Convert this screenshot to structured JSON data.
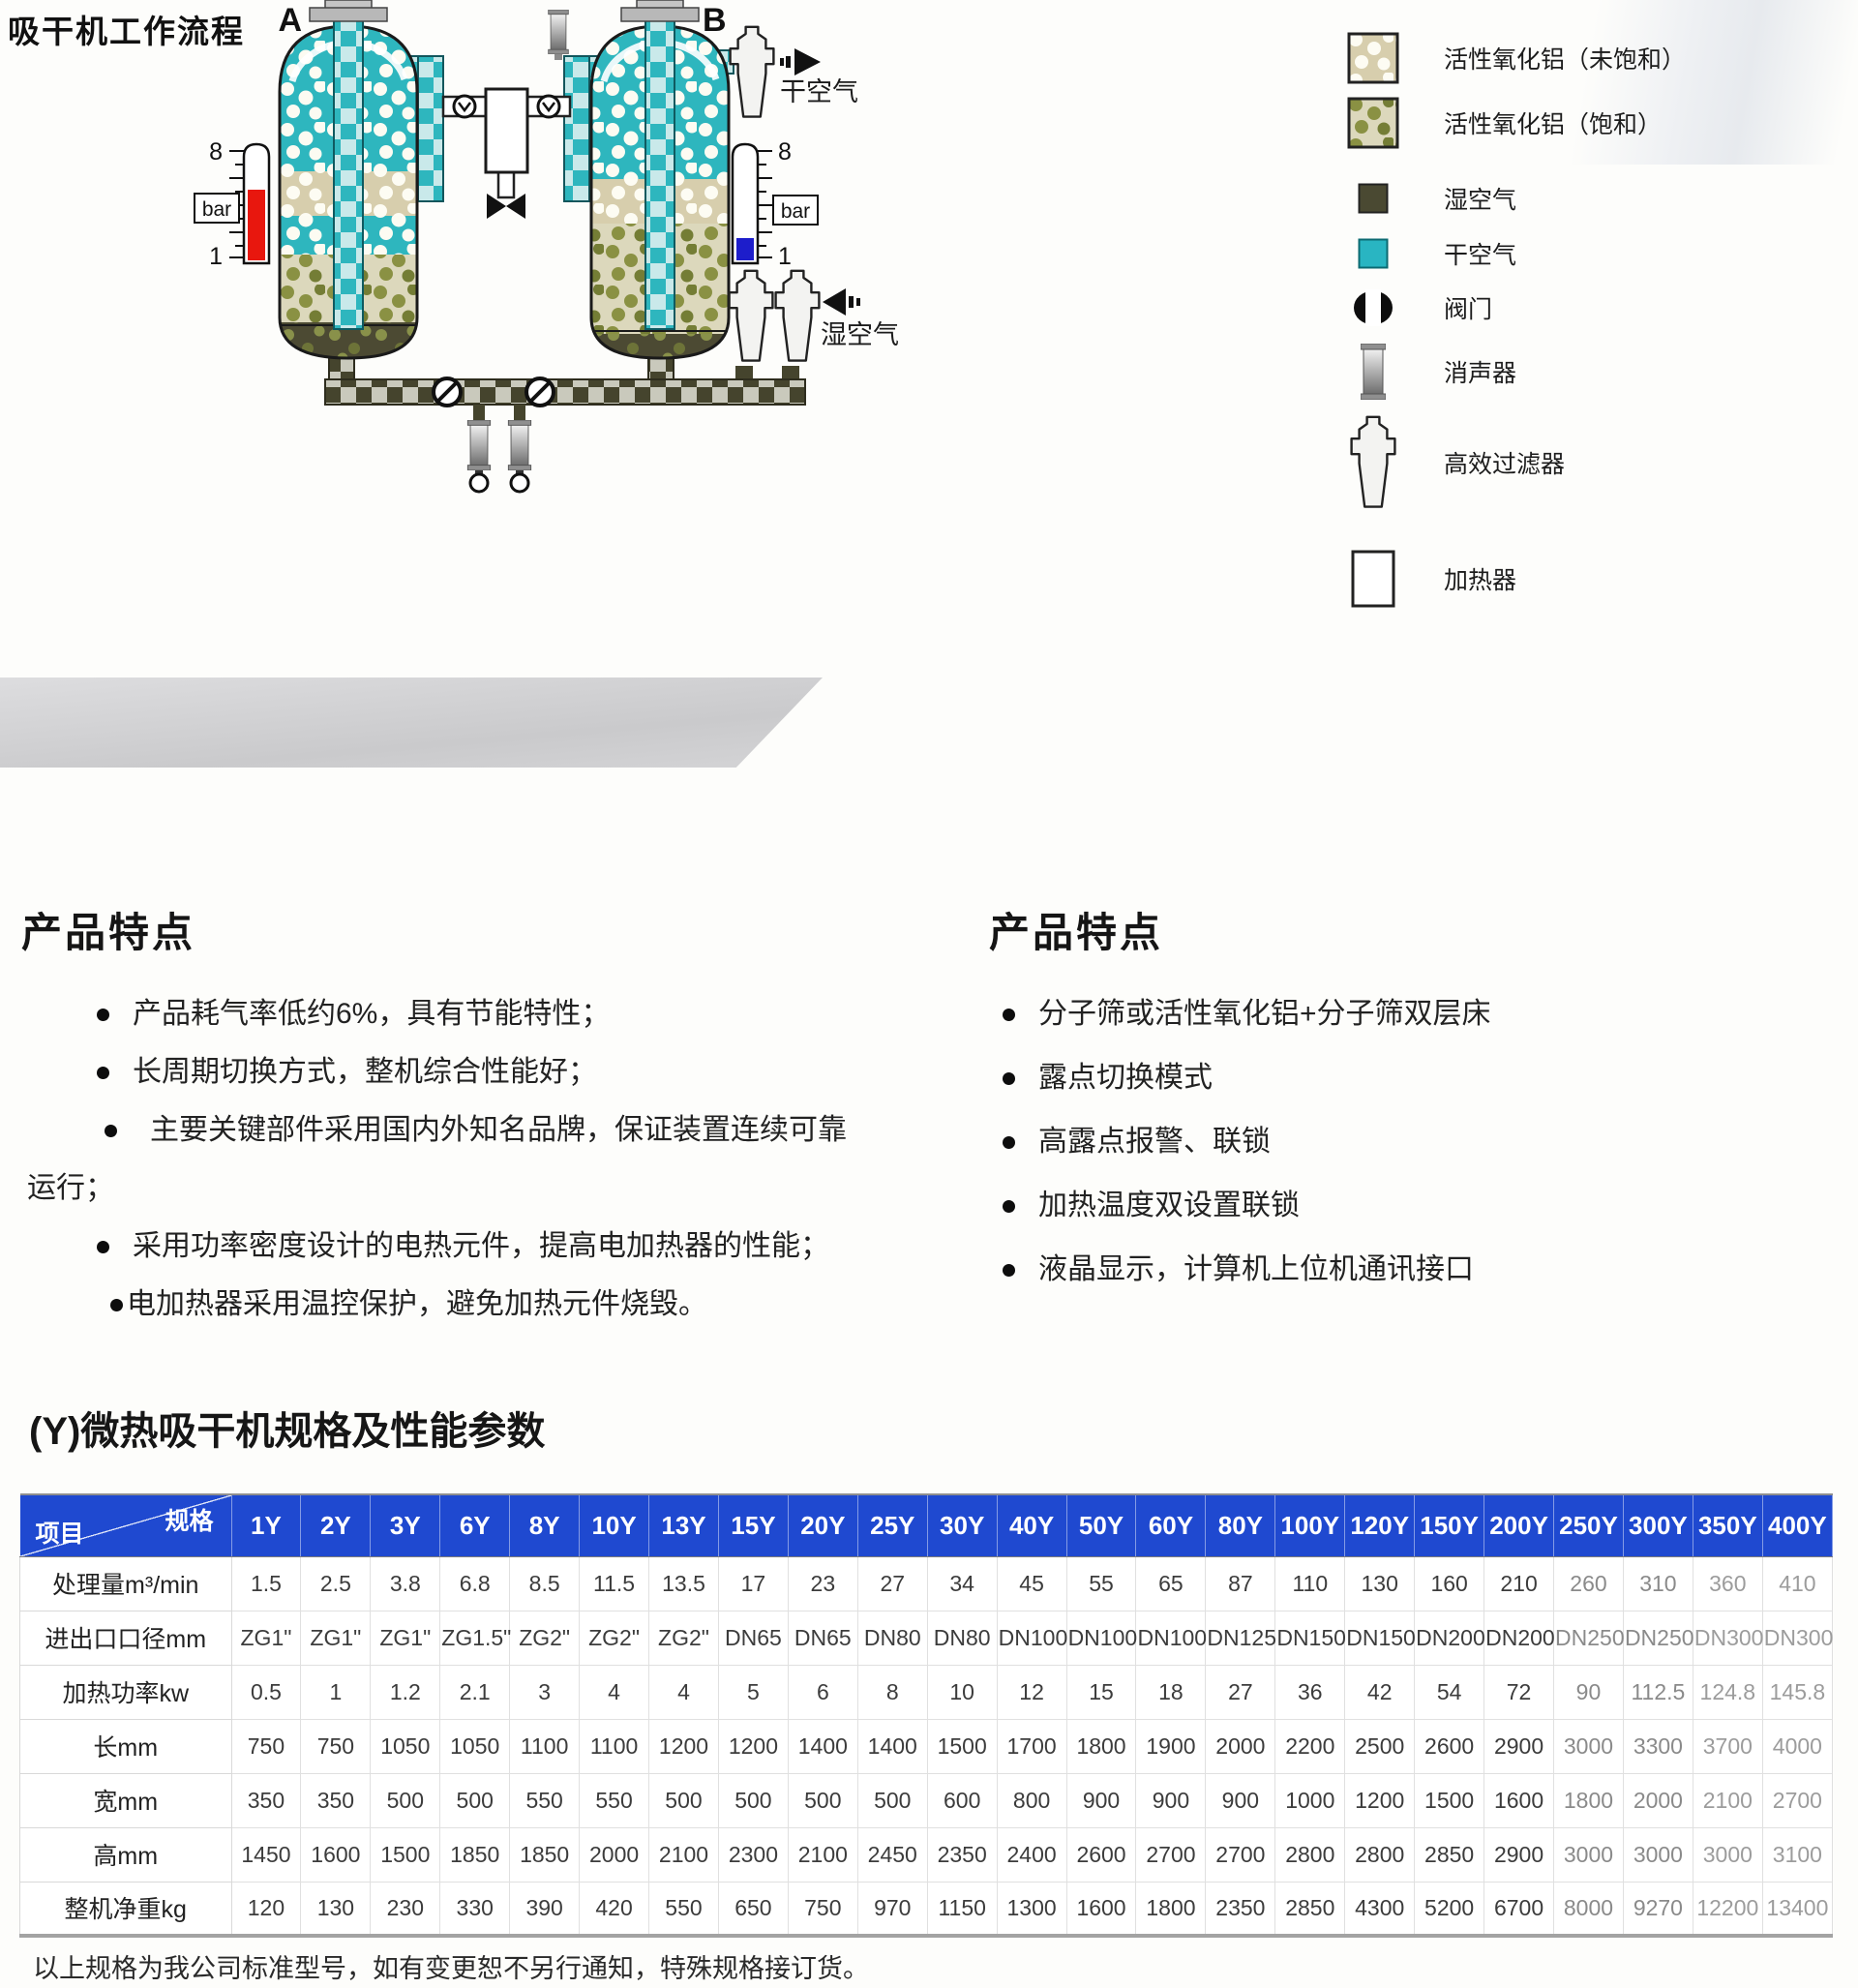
{
  "page": {
    "title": "吸干机工作流程",
    "note": "以上规格为我公司标准型号，如有变更恕不另行通知，特殊规格接订货。"
  },
  "diagram": {
    "vessel_a": "A",
    "vessel_b": "B",
    "dry_air": "干空气",
    "wet_air": "湿空气",
    "bar": "bar",
    "gauge_max": "8",
    "gauge_min": "1",
    "legend": [
      {
        "icon": "alumina-unsaturated-swatch",
        "label": "活性氧化铝（未饱和）"
      },
      {
        "icon": "alumina-saturated-swatch",
        "label": "活性氧化铝（饱和）"
      },
      {
        "icon": "wet-air-swatch",
        "label": "湿空气"
      },
      {
        "icon": "dry-air-swatch",
        "label": "干空气"
      },
      {
        "icon": "valve-icon",
        "label": "阀门"
      },
      {
        "icon": "muffler-icon",
        "label": "消声器"
      },
      {
        "icon": "filter-icon",
        "label": "高效过滤器"
      },
      {
        "icon": "heater-icon",
        "label": "加热器"
      }
    ]
  },
  "features_left": {
    "heading": "产品特点",
    "items": [
      {
        "bullet": true,
        "text": "产品耗气率低约6%，具有节能特性；"
      },
      {
        "bullet": true,
        "text": "长周期切换方式，整机综合性能好；"
      },
      {
        "bullet": true,
        "text": "主要关键部件采用国内外知名品牌，保证装置连续可靠"
      },
      {
        "bullet": false,
        "text": "运行；"
      },
      {
        "bullet": true,
        "text": "采用功率密度设计的电热元件，提高电加热器的性能；"
      },
      {
        "bullet": true,
        "text": "电加热器采用温控保护，避免加热元件烧毁。"
      }
    ]
  },
  "features_right": {
    "heading": "产品特点",
    "items": [
      {
        "bullet": true,
        "text": "分子筛或活性氧化铝+分子筛双层床"
      },
      {
        "bullet": true,
        "text": "露点切换模式"
      },
      {
        "bullet": true,
        "text": "高露点报警、联锁"
      },
      {
        "bullet": true,
        "text": "加热温度双设置联锁"
      },
      {
        "bullet": true,
        "text": "液晶显示，计算机上位机通讯接口"
      }
    ]
  },
  "spec_table": {
    "title": "(Y)微热吸干机规格及性能参数",
    "corner": {
      "top_right": "规格",
      "bottom_left": "项目"
    },
    "models": [
      "1Y",
      "2Y",
      "3Y",
      "6Y",
      "8Y",
      "10Y",
      "13Y",
      "15Y",
      "20Y",
      "25Y",
      "30Y",
      "40Y",
      "50Y",
      "60Y",
      "80Y",
      "100Y",
      "120Y",
      "150Y",
      "200Y",
      "250Y",
      "300Y",
      "350Y",
      "400Y"
    ],
    "rows": [
      {
        "label": "处理量m³/min",
        "values": [
          "1.5",
          "2.5",
          "3.8",
          "6.8",
          "8.5",
          "11.5",
          "13.5",
          "17",
          "23",
          "27",
          "34",
          "45",
          "55",
          "65",
          "87",
          "110",
          "130",
          "160",
          "210",
          "260",
          "310",
          "360",
          "410"
        ]
      },
      {
        "label": "进出口口径mm",
        "values": [
          "ZG1\"",
          "ZG1\"",
          "ZG1\"",
          "ZG1.5\"",
          "ZG2\"",
          "ZG2\"",
          "ZG2\"",
          "DN65",
          "DN65",
          "DN80",
          "DN80",
          "DN100",
          "DN100",
          "DN100",
          "DN125",
          "DN150",
          "DN150",
          "DN200",
          "DN200",
          "DN250",
          "DN250",
          "DN300",
          "DN300"
        ]
      },
      {
        "label": "加热功率kw",
        "values": [
          "0.5",
          "1",
          "1.2",
          "2.1",
          "3",
          "4",
          "4",
          "5",
          "6",
          "8",
          "10",
          "12",
          "15",
          "18",
          "27",
          "36",
          "42",
          "54",
          "72",
          "90",
          "112.5",
          "124.8",
          "145.8"
        ]
      },
      {
        "label": "长mm",
        "values": [
          "750",
          "750",
          "1050",
          "1050",
          "1100",
          "1100",
          "1200",
          "1200",
          "1400",
          "1400",
          "1500",
          "1700",
          "1800",
          "1900",
          "2000",
          "2200",
          "2500",
          "2600",
          "2900",
          "3000",
          "3300",
          "3700",
          "4000"
        ]
      },
      {
        "label": "宽mm",
        "values": [
          "350",
          "350",
          "500",
          "500",
          "550",
          "550",
          "500",
          "500",
          "500",
          "500",
          "600",
          "800",
          "900",
          "900",
          "900",
          "1000",
          "1200",
          "1500",
          "1600",
          "1800",
          "2000",
          "2100",
          "2700"
        ]
      },
      {
        "label": "高mm",
        "values": [
          "1450",
          "1600",
          "1500",
          "1850",
          "1850",
          "2000",
          "2100",
          "2300",
          "2100",
          "2450",
          "2350",
          "2400",
          "2600",
          "2700",
          "2700",
          "2800",
          "2800",
          "2850",
          "2900",
          "3000",
          "3000",
          "3000",
          "3100"
        ]
      },
      {
        "label": "整机净重kg",
        "values": [
          "120",
          "130",
          "230",
          "330",
          "390",
          "420",
          "550",
          "650",
          "750",
          "970",
          "1150",
          "1300",
          "1600",
          "1800",
          "2350",
          "2850",
          "4300",
          "5200",
          "6700",
          "8000",
          "9270",
          "12200",
          "13400"
        ]
      }
    ]
  },
  "colors": {
    "header_blue": "#1f49d0",
    "dry_air_teal": "#29b5c2",
    "wet_air_olive": "#4a4932",
    "gauge_red": "#e8170e",
    "gauge_blue": "#1d1dcb"
  }
}
